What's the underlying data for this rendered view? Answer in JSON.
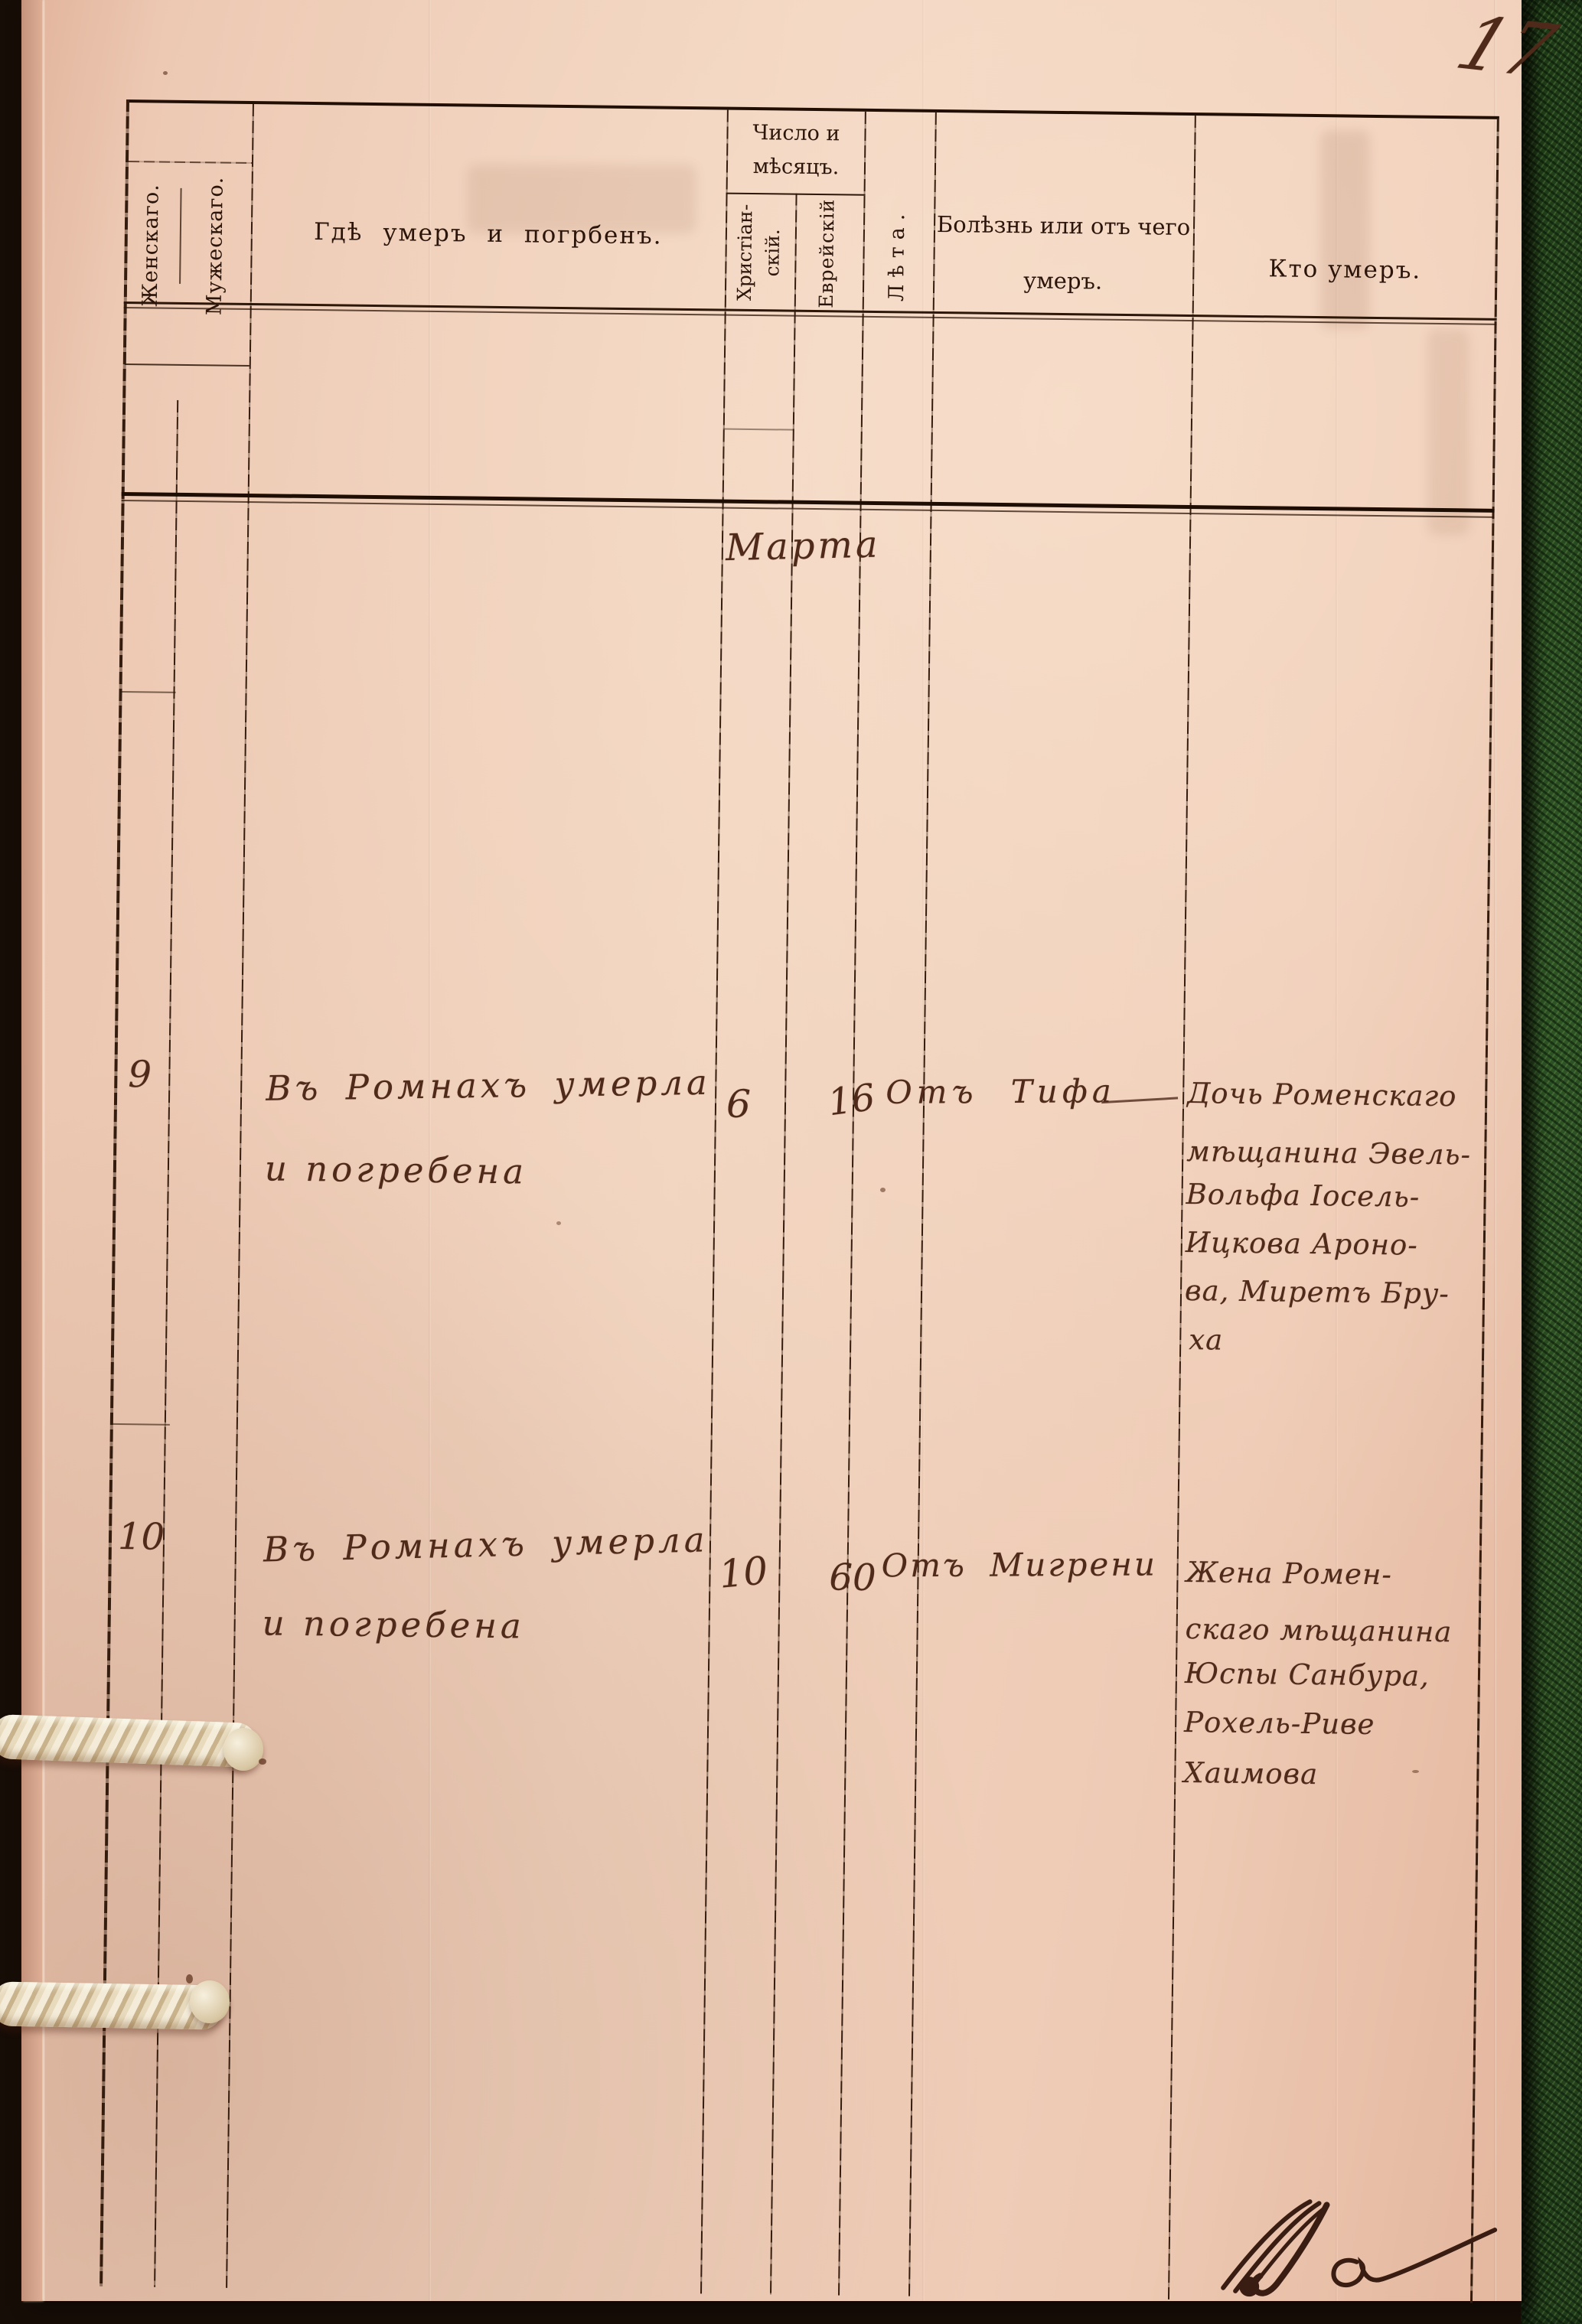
{
  "page": {
    "number": "17"
  },
  "colors": {
    "paper": "#eecab4",
    "handwriting_ink": "#4f2a1b",
    "printed_ink": "#2b150a",
    "cover_green": "#2f5526",
    "rope": "#e8dabd"
  },
  "table": {
    "headers": {
      "col_female": "Женскаго.",
      "col_male": "Мужескаго.",
      "col_where": "Гдѣ умеръ и погрбенъ.",
      "col_date_group_l1": "Число и",
      "col_date_group_l2": "мѣсяцъ.",
      "col_date_christian_l1": "Христіан-",
      "col_date_christian_l2": "скій.",
      "col_date_jewish": "Еврейскій",
      "col_age": "Лѣта.",
      "col_cause_l1": "Болѣзнь или отъ чего",
      "col_cause_l2": "умеръ.",
      "col_who": "Кто умеръ."
    },
    "month_label": "Марта",
    "entries": [
      {
        "number": "9",
        "where_line1": "Въ Ромнахъ умерла",
        "where_line2": "и погребена",
        "date_christian": "6",
        "age": "16",
        "cause": "Отъ Тифа",
        "who_lines": [
          "Дочь Роменскаго",
          "мѣщанина Эвель-",
          "Вольфа Іосель-",
          "Ицкова Ароно-",
          "ва, Миретъ Бру-",
          "ха"
        ]
      },
      {
        "number": "10",
        "where_line1": "Въ Ромнахъ умерла",
        "where_line2": "и погребена",
        "date_christian": "10",
        "age": "60",
        "cause": "Отъ Мигрени",
        "who_lines": [
          "Жена Ромен-",
          "скаго мѣщанина",
          "Юспы Санбура,",
          "Рохель-Риве",
          "Хаимова"
        ]
      }
    ]
  }
}
